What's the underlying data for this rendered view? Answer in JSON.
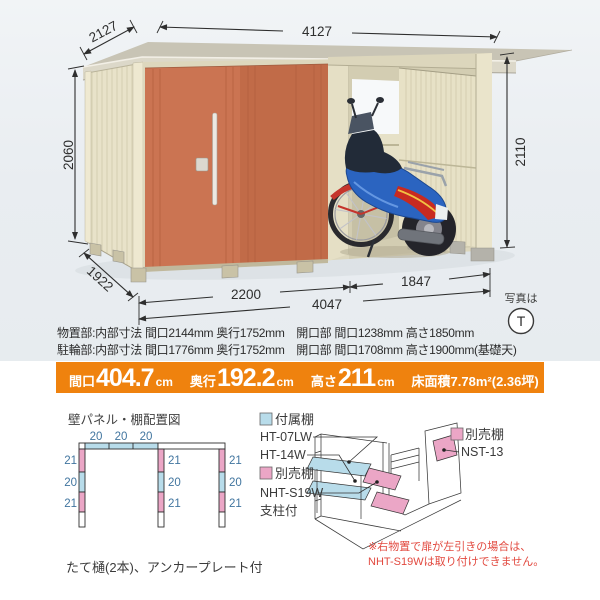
{
  "illustration": {
    "dims": {
      "depth_top": "2127",
      "width_top": "4127",
      "height_left": "2060",
      "height_right": "2110",
      "depth_bottom": "1922",
      "width_storage": "2200",
      "width_total": "4047",
      "width_bike": "1847"
    },
    "photo_note": "写真は",
    "photo_mark": "T"
  },
  "specs": {
    "line1": "物置部:内部寸法 間口2144mm 奥行1752mm　開口部 間口1238mm 高さ1850mm",
    "line2": "駐輪部:内部寸法 間口1776mm 奥行1752mm　開口部 間口1708mm 高さ1900mm(基礎天)"
  },
  "summary": {
    "items": [
      {
        "label": "間口",
        "value": "404.7",
        "unit": "cm"
      },
      {
        "label": "奥行",
        "value": "192.2",
        "unit": "cm"
      },
      {
        "label": "高さ",
        "value": "211",
        "unit": "cm"
      }
    ],
    "area": "床面積7.78m²(2.36坪)"
  },
  "panel_diagram": {
    "title": "壁パネル・棚配置図",
    "top_labels": [
      "20",
      "20",
      "20"
    ],
    "left_labels": [
      "21",
      "20",
      "21"
    ],
    "mid_labels": [
      "21",
      "20",
      "21"
    ],
    "right_labels": [
      "21",
      "20",
      "21"
    ]
  },
  "shelf_diagram": {
    "attached_label": "付属棚",
    "attached_model1": "HT-07LW",
    "attached_model2": "HT-14W",
    "optional_label": "別売棚",
    "optional_model": "NHT-S19W",
    "optional_note": "支柱付",
    "optional2_label": "別売棚",
    "optional2_model": "NST-13"
  },
  "notes": {
    "warning_line1": "※右物置で扉が左引きの場合は、",
    "warning_line2": "NHT-S19Wは取り付けできません。",
    "footer": "たて樋(2本)、アンカープレート付"
  },
  "colors": {
    "accent_orange": "#ef820e",
    "panel_blue": "#b8dcea",
    "panel_pink": "#eba6c6",
    "warning_red": "#e2493f",
    "door_orange": "#cb7452"
  }
}
